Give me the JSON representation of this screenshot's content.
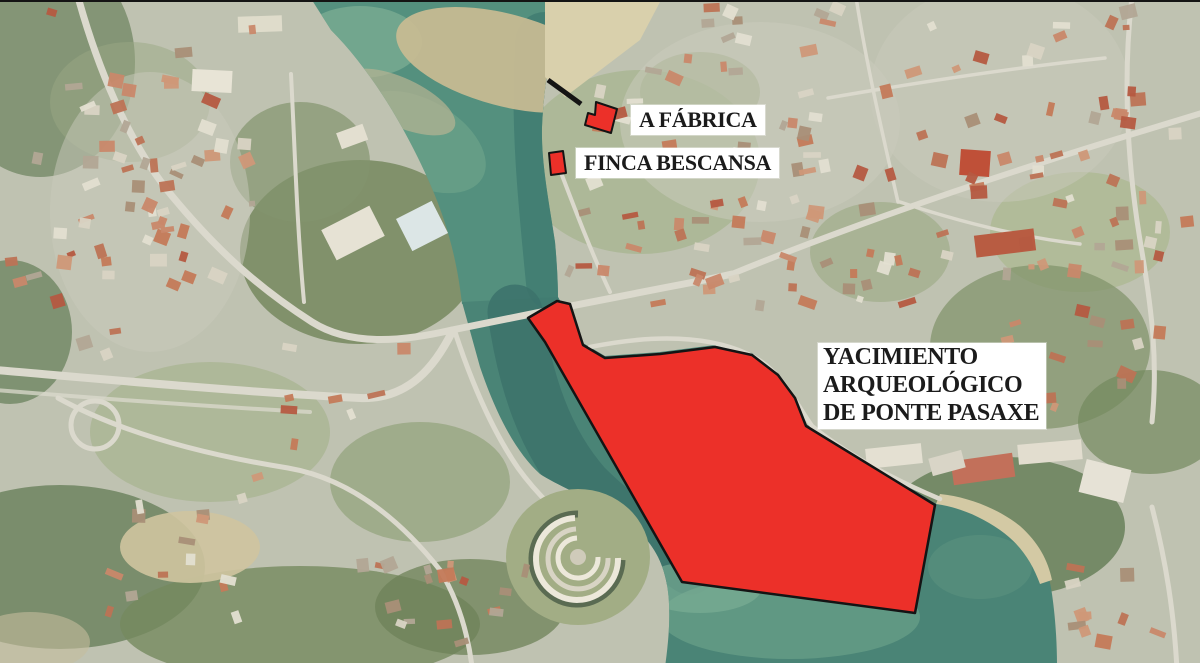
{
  "labels": {
    "fabrica": "A FÁBRICA",
    "finca_bescansa": "FINCA BESCANSA",
    "yacimiento_line1": "YACIMIENTO",
    "yacimiento_line2": "ARQUEOLÓGICO",
    "yacimiento_line3": "DE PONTE PASAXE"
  },
  "colors": {
    "overlay_red": "#ec3029",
    "overlay_outline": "#141414",
    "label_bg": "#ffffff",
    "label_text": "#1b1b1b",
    "water_deep": "#47857a",
    "water_shallow": "#6fa68e",
    "sandbar": "#c6ba92",
    "land_base": "#bfc2b1"
  },
  "overlays": {
    "site_polygon_points": "557,299 570,302 583,343 605,356 660,352 715,345 752,353 778,373 795,396 806,424 935,503 915,611 682,580 545,340 528,316",
    "fabrica_polygon_points": "596,100 617,107 611,131 585,123 588,111 595,113",
    "bescansa_polygon_points": "549,151 563,149 566,171 551,173",
    "pointer_line": {
      "x1": 548,
      "y1": 78,
      "x2": 581,
      "y2": 102
    }
  }
}
